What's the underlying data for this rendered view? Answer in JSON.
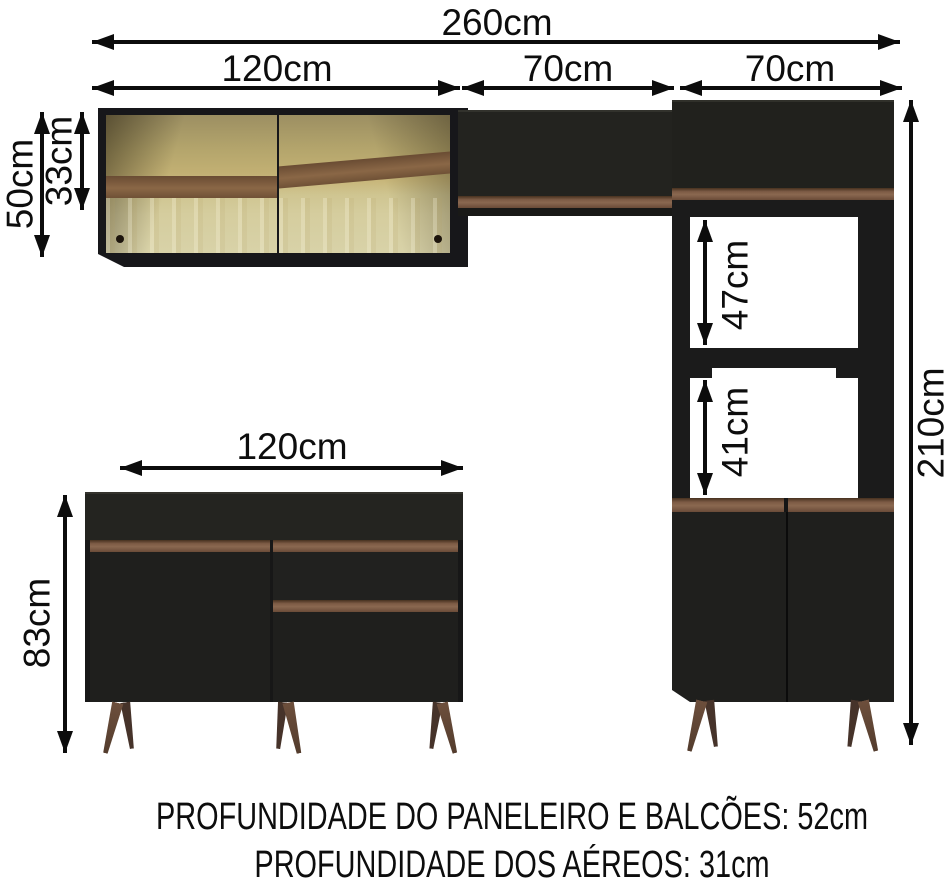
{
  "diagram": {
    "subject": "modular kitchen cabinet set with dimension arrows",
    "dims": {
      "total_width": "260cm",
      "upper_left_width": "120cm",
      "upper_mid_width": "70cm",
      "upper_right_width": "70cm",
      "wall_cabinet_height": "50cm",
      "wall_cabinet_inner_height": "33cm",
      "niche_upper_height": "47cm",
      "niche_lower_height": "41cm",
      "total_height": "210cm",
      "base_cabinet_width": "120cm",
      "base_cabinet_height": "83cm"
    },
    "footer": {
      "line1": "PROFUNDIDADE DO PANELEIRO E BALCÕES: 52cm",
      "line2": "PROFUNDIDADE DOS AÉREOS: 31cm"
    },
    "colors": {
      "background": "#ffffff",
      "arrow": "#0c0c0c",
      "cabinet_black": "#1e1e1c",
      "wood_handle": "#7d5b45",
      "leg_wood": "#5f4636",
      "glass_amber": "#c2b073",
      "glass_pale": "#d8d2a8",
      "glass_reflection_band": "#7a5a3b"
    }
  }
}
